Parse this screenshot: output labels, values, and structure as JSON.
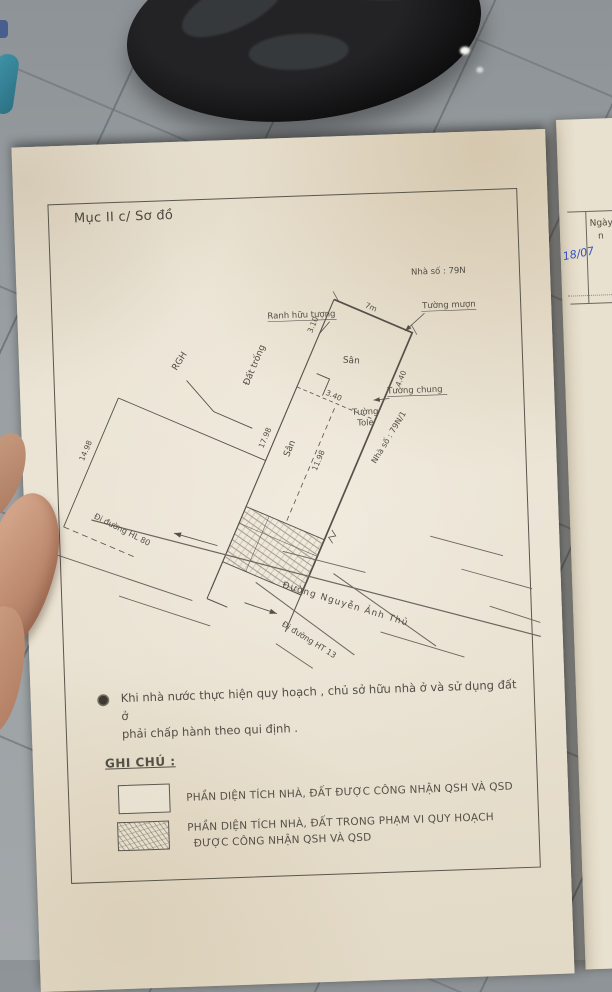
{
  "page": {
    "section_title": "Mục II c/ Sơ đồ",
    "note": {
      "line1": "Khi nhà nước thực hiện quy hoạch , chủ sở hữu nhà ở và sử dụng đất ở",
      "line2": "phải chấp hành theo qui định ."
    },
    "legend": {
      "title": "GHI CHÚ :",
      "items": [
        {
          "label": "PHẦN DIỆN TÍCH NHÀ, ĐẤT ĐƯỢC CÔNG NHẬN QSH VÀ QSD"
        },
        {
          "label_line1": "PHẦN DIỆN TÍCH NHÀ, ĐẤT TRONG PHẠM VI QUY HOẠCH",
          "label_line2": "ĐƯỢC CÔNG NHẬN QSH VÀ QSD"
        }
      ]
    }
  },
  "diagram": {
    "labels": {
      "house_no": "Nhà số : 79N",
      "house_no_2": "Nhà số : 79N/1",
      "borrowed_wall": "Tường mượn",
      "symbolic_boundary": "Ranh hữu tượng",
      "shared_wall": "Tường chung",
      "tole_wall_line1": "Tường",
      "tole_wall_line2": "Tole",
      "yard": "Sân",
      "empty_land": "Đất trống",
      "rgh": "RGH",
      "street_main": "Đường Nguyễn Ảnh Thủ",
      "to_road_hl80": "Đi đường HL 80",
      "to_road_ht13": "Đi đường HT 13"
    },
    "dimensions": {
      "top_edge": "7m",
      "d310": "3.10",
      "d340": "3.40",
      "d440": "4.40",
      "d1198": "11.98",
      "d1798": "17.98",
      "d1498": "14.98"
    }
  },
  "right_page": {
    "header": "Ngày",
    "header_cont": "n",
    "handwriting": "18/07"
  },
  "colors": {
    "paper": "#eae3d4",
    "ink": "#55504a",
    "handwriting_blue": "#3450c0",
    "floor": "#95999c"
  }
}
